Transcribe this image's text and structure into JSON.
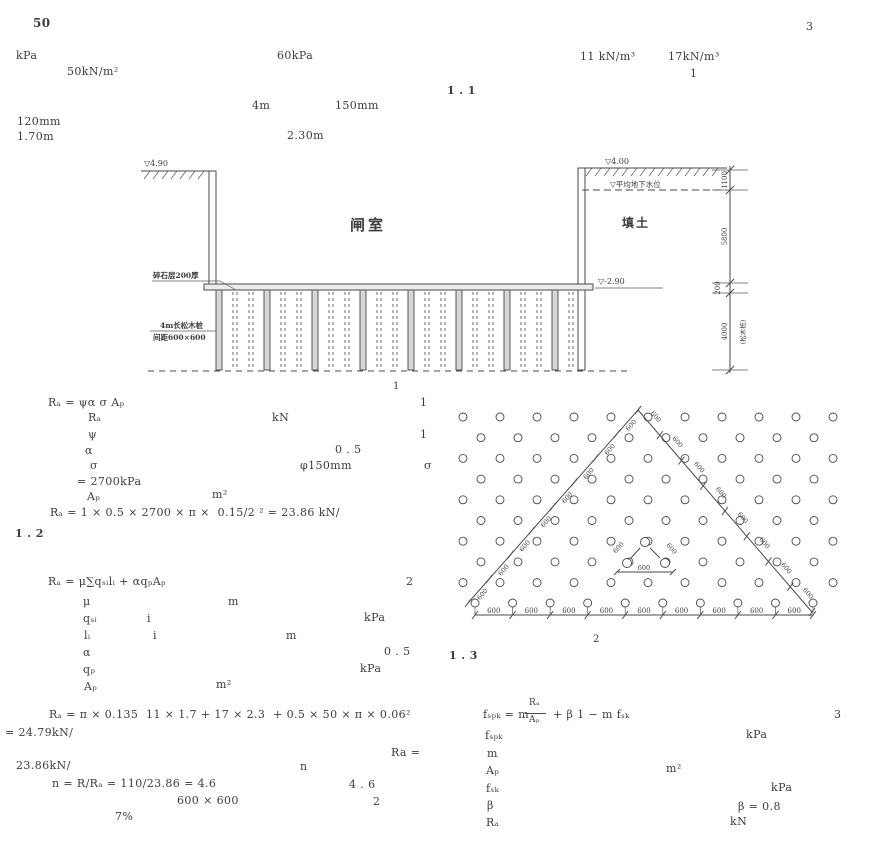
{
  "header": {
    "page_number": "50",
    "chapter_number": "3"
  },
  "figure1": {
    "caption": "1",
    "label_chamber": "闸室",
    "label_fill": "填土",
    "elev_left": "▽4.90",
    "elev_right": "▽4.00",
    "water_level_label": "▽平均地下水位",
    "elev_bottom": "▽-2.90",
    "label_cushion": "碎石层200厚",
    "label_pile_line1": "4m长松木桩",
    "label_pile_line2": "间距600×600",
    "dim_labels": [
      "1100",
      "5800",
      "200",
      "4000"
    ],
    "dim_note": "(松木桩)",
    "pile_columns": 23
  },
  "figure2": {
    "caption": "2",
    "spacing_label": "600",
    "bottom_segments": 9,
    "diagonal_segments": 8,
    "detail_labels": [
      "600",
      "600",
      "600"
    ]
  },
  "text_runs": [
    {
      "n": "page-number",
      "x": 33,
      "y": 17,
      "t": "50",
      "s": 12,
      "b": 1
    },
    {
      "n": "chapter-number",
      "x": 806,
      "y": 21,
      "t": "3"
    },
    {
      "n": "problem-run",
      "x": 16,
      "y": 50,
      "t": "kPa"
    },
    {
      "n": "problem-run",
      "x": 277,
      "y": 50,
      "t": "60kPa"
    },
    {
      "n": "problem-run",
      "x": 580,
      "y": 51,
      "t": "11 kN/m³"
    },
    {
      "n": "problem-run",
      "x": 668,
      "y": 51,
      "t": "17kN/m³"
    },
    {
      "n": "problem-run",
      "x": 67,
      "y": 66,
      "t": "50kN/m²"
    },
    {
      "n": "problem-run",
      "x": 690,
      "y": 68,
      "t": "1"
    },
    {
      "n": "section-1-1",
      "x": 447,
      "y": 85,
      "t": "1 . 1",
      "b": 1
    },
    {
      "n": "problem-run",
      "x": 252,
      "y": 100,
      "t": "4m"
    },
    {
      "n": "problem-run",
      "x": 335,
      "y": 100,
      "t": "150mm"
    },
    {
      "n": "problem-run",
      "x": 17,
      "y": 116,
      "t": "120mm"
    },
    {
      "n": "problem-run",
      "x": 17,
      "y": 131,
      "t": "1.70m"
    },
    {
      "n": "problem-run",
      "x": 287,
      "y": 130,
      "t": "2.30m"
    },
    {
      "n": "eq1",
      "x": 48,
      "y": 397,
      "t": "Rₐ = ψα σ Aₚ"
    },
    {
      "n": "eq1-number",
      "x": 420,
      "y": 397,
      "t": "1"
    },
    {
      "n": "sol-run",
      "x": 88,
      "y": 412,
      "t": "Rₐ"
    },
    {
      "n": "sol-run",
      "x": 272,
      "y": 412,
      "t": "kN"
    },
    {
      "n": "sol-run",
      "x": 88,
      "y": 429,
      "t": "ψ"
    },
    {
      "n": "sol-run",
      "x": 420,
      "y": 429,
      "t": "1"
    },
    {
      "n": "sol-run",
      "x": 85,
      "y": 445,
      "t": "α"
    },
    {
      "n": "sol-run",
      "x": 335,
      "y": 444,
      "t": "0 . 5"
    },
    {
      "n": "sol-run",
      "x": 90,
      "y": 460,
      "t": "σ"
    },
    {
      "n": "sol-run",
      "x": 300,
      "y": 460,
      "t": "φ150mm"
    },
    {
      "n": "sol-run",
      "x": 424,
      "y": 460,
      "t": "σ"
    },
    {
      "n": "sol-run",
      "x": 77,
      "y": 476,
      "t": "= 2700kPa"
    },
    {
      "n": "sol-run",
      "x": 87,
      "y": 491,
      "t": "Aₚ"
    },
    {
      "n": "sol-run",
      "x": 212,
      "y": 489,
      "t": "m²"
    },
    {
      "n": "calc-1",
      "x": 50,
      "y": 507,
      "t": "Rₐ = 1 × 0.5 × 2700 × π ×  0.15/2 ² = 23.86 kN/"
    },
    {
      "n": "section-1-2",
      "x": 15,
      "y": 528,
      "t": "1 . 2",
      "b": 1
    },
    {
      "n": "eq2",
      "x": 48,
      "y": 576,
      "t": "Rₐ = μ∑qₛᵢlᵢ + αqₚAₚ"
    },
    {
      "n": "eq2-number",
      "x": 406,
      "y": 576,
      "t": "2"
    },
    {
      "n": "sol-run",
      "x": 83,
      "y": 596,
      "t": "μ"
    },
    {
      "n": "sol-run",
      "x": 228,
      "y": 596,
      "t": "m"
    },
    {
      "n": "sol-run",
      "x": 83,
      "y": 613,
      "t": "qₛᵢ"
    },
    {
      "n": "sol-run",
      "x": 147,
      "y": 613,
      "t": "i"
    },
    {
      "n": "sol-run",
      "x": 364,
      "y": 612,
      "t": "kPa"
    },
    {
      "n": "sol-run",
      "x": 84,
      "y": 630,
      "t": "lᵢ"
    },
    {
      "n": "sol-run",
      "x": 153,
      "y": 630,
      "t": "i"
    },
    {
      "n": "sol-run",
      "x": 286,
      "y": 630,
      "t": "m"
    },
    {
      "n": "sol-run",
      "x": 83,
      "y": 647,
      "t": "α"
    },
    {
      "n": "sol-run",
      "x": 384,
      "y": 646,
      "t": "0 . 5"
    },
    {
      "n": "sol-run",
      "x": 83,
      "y": 664,
      "t": "qₚ"
    },
    {
      "n": "sol-run",
      "x": 360,
      "y": 663,
      "t": "kPa"
    },
    {
      "n": "sol-run",
      "x": 84,
      "y": 681,
      "t": "Aₚ"
    },
    {
      "n": "sol-run",
      "x": 216,
      "y": 679,
      "t": "m²"
    },
    {
      "n": "calc-2a",
      "x": 49,
      "y": 709,
      "t": "Rₐ = π × 0.135  11 × 1.7 + 17 × 2.3  + 0.5 × 50 × π × 0.06²"
    },
    {
      "n": "calc-2b",
      "x": 5,
      "y": 727,
      "t": "= 24.79kN/"
    },
    {
      "n": "sol-run",
      "x": 391,
      "y": 747,
      "t": "Ra ="
    },
    {
      "n": "sol-run",
      "x": 16,
      "y": 760,
      "t": "23.86kN/"
    },
    {
      "n": "sol-run",
      "x": 300,
      "y": 761,
      "t": "n"
    },
    {
      "n": "calc-2c",
      "x": 52,
      "y": 778,
      "t": "n = R/Rₐ = 110/23.86 = 4.6"
    },
    {
      "n": "sol-run",
      "x": 349,
      "y": 779,
      "t": "4 . 6"
    },
    {
      "n": "sol-run",
      "x": 177,
      "y": 795,
      "t": "600 × 600"
    },
    {
      "n": "sol-run",
      "x": 373,
      "y": 796,
      "t": "2"
    },
    {
      "n": "sol-run",
      "x": 115,
      "y": 811,
      "t": "7%"
    },
    {
      "n": "section-1-3",
      "x": 449,
      "y": 650,
      "t": "1 . 3",
      "b": 1
    },
    {
      "n": "eq3-prefix",
      "x": 483,
      "y": 709,
      "t": "fₛₚₖ = m"
    },
    {
      "n": "eq3-frac-num",
      "x": 529,
      "y": 699,
      "t": "Rₐ",
      "s": 9
    },
    {
      "n": "eq3-frac-den",
      "x": 529,
      "y": 716,
      "t": "Aₚ",
      "s": 9
    },
    {
      "n": "eq3-suffix",
      "x": 553,
      "y": 709,
      "t": "+ β 1 − m fₛₖ"
    },
    {
      "n": "eq3-number",
      "x": 834,
      "y": 709,
      "t": "3"
    },
    {
      "n": "sol-run",
      "x": 485,
      "y": 730,
      "t": "fₛₚₖ"
    },
    {
      "n": "sol-run",
      "x": 746,
      "y": 729,
      "t": "kPa"
    },
    {
      "n": "sol-run",
      "x": 487,
      "y": 748,
      "t": "m"
    },
    {
      "n": "sol-run",
      "x": 486,
      "y": 765,
      "t": "Aₚ"
    },
    {
      "n": "sol-run",
      "x": 666,
      "y": 763,
      "t": "m²"
    },
    {
      "n": "sol-run",
      "x": 486,
      "y": 783,
      "t": "fₛₖ"
    },
    {
      "n": "sol-run",
      "x": 771,
      "y": 782,
      "t": "kPa"
    },
    {
      "n": "sol-run",
      "x": 487,
      "y": 800,
      "t": "β"
    },
    {
      "n": "sol-run",
      "x": 738,
      "y": 801,
      "t": "β = 0.8"
    },
    {
      "n": "sol-run",
      "x": 486,
      "y": 817,
      "t": "Rₐ"
    },
    {
      "n": "sol-run",
      "x": 730,
      "y": 816,
      "t": "kN"
    }
  ]
}
